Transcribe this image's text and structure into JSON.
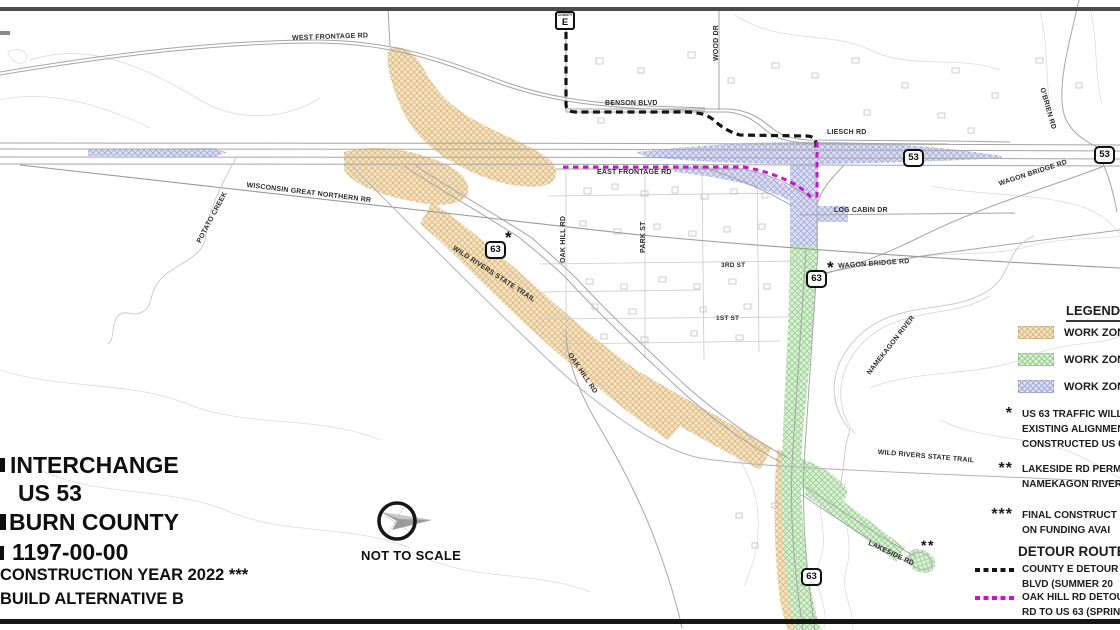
{
  "colors": {
    "orange_fill": "#f4e4c4",
    "orange_hatch": "#ddb97f",
    "green_fill": "#ddf1d7",
    "green_hatch": "#96d190",
    "purple_fill": "#dde0f3",
    "purple_hatch": "#a3abdc",
    "black_detour": "#151515",
    "magenta_detour": "#cf10cf"
  },
  "title_block": {
    "lines": [
      {
        "text": "INTERCHANGE",
        "x": 10,
        "y": 454,
        "size": 23
      },
      {
        "text": "US 53",
        "x": 18,
        "y": 482,
        "size": 23
      },
      {
        "text": "BURN COUNTY",
        "x": 9,
        "y": 511,
        "size": 23
      },
      {
        "text": "1197-00-00",
        "x": 12,
        "y": 541,
        "size": 23
      },
      {
        "text": "CONSTRUCTION YEAR 2022  ***",
        "x": 0,
        "y": 567,
        "size": 16.5
      },
      {
        "text": "BUILD ALTERNATIVE B",
        "x": 0,
        "y": 591,
        "size": 16.5
      }
    ]
  },
  "compass": {
    "label": "NOT TO SCALE"
  },
  "legend": {
    "title": "LEGEND",
    "items": [
      {
        "label": "WORK ZON",
        "fill": "#f4e4c4",
        "hatch": "#ddb97f"
      },
      {
        "label": "WORK ZON",
        "fill": "#ddf1d7",
        "hatch": "#96d190"
      },
      {
        "label": "WORK ZON",
        "fill": "#dde0f3",
        "hatch": "#a3abdc"
      }
    ],
    "notes": [
      {
        "marker": "*",
        "lines": [
          "US 63 TRAFFIC WILL",
          "EXISTING ALIGNMEN",
          "CONSTRUCTED US 6"
        ]
      },
      {
        "marker": "**",
        "lines": [
          "LAKESIDE RD PERM",
          "NAMEKAGON RIVER"
        ]
      },
      {
        "marker": "***",
        "lines": [
          "FINAL CONSTRUCT",
          "ON FUNDING AVAI"
        ]
      }
    ],
    "detours": {
      "title": "DETOUR ROUTES",
      "items": [
        {
          "color": "#151515",
          "lines": [
            "COUNTY E DETOUR",
            "BLVD (SUMMER 20"
          ]
        },
        {
          "color": "#cf10cf",
          "lines": [
            "OAK HILL RD DETOU",
            "RD TO US 63 (SPRIN"
          ]
        }
      ]
    }
  },
  "map": {
    "labels": [
      {
        "text": "WEST FRONTAGE RD",
        "x": 292,
        "y": 35,
        "rot": -2,
        "size": 7
      },
      {
        "text": "BENSON BLVD",
        "x": 605,
        "y": 100,
        "rot": 0,
        "size": 7
      },
      {
        "text": "LIESCH RD",
        "x": 827,
        "y": 129,
        "rot": 0,
        "size": 7
      },
      {
        "text": "WOOD DR",
        "x": 713,
        "y": 61,
        "rot": -90,
        "size": 7
      },
      {
        "text": "O'BRIEN RD",
        "x": 1045,
        "y": 87,
        "rot": 74,
        "size": 7
      },
      {
        "text": "EAST FRONTAGE RD",
        "x": 597,
        "y": 169,
        "rot": 0,
        "size": 7
      },
      {
        "text": "LOG CABIN DR",
        "x": 834,
        "y": 207,
        "rot": 0,
        "size": 7
      },
      {
        "text": "WISCONSIN GREAT NORTHERN RR",
        "x": 247,
        "y": 182,
        "rot": 7,
        "size": 7
      },
      {
        "text": "POTATO CREEK",
        "x": 196,
        "y": 241,
        "rot": -62,
        "size": 7
      },
      {
        "text": "WILD RIVERS STATE TRAIL",
        "x": 455,
        "y": 245,
        "rot": 33,
        "size": 7
      },
      {
        "text": "OAK HILL RD",
        "x": 560,
        "y": 263,
        "rot": -90,
        "size": 7
      },
      {
        "text": "PARK ST",
        "x": 640,
        "y": 253,
        "rot": -90,
        "size": 7
      },
      {
        "text": "3RD ST",
        "x": 721,
        "y": 263,
        "rot": 0,
        "size": 6.5
      },
      {
        "text": "1ST ST",
        "x": 716,
        "y": 316,
        "rot": 0,
        "size": 6.5
      },
      {
        "text": "OAK HILL RD",
        "x": 572,
        "y": 352,
        "rot": 56,
        "size": 7
      },
      {
        "text": "WAGON BRIDGE RD",
        "x": 838,
        "y": 263,
        "rot": -4,
        "size": 7
      },
      {
        "text": "NAMEKAGON RIVER",
        "x": 866,
        "y": 372,
        "rot": -52,
        "size": 7
      },
      {
        "text": "WILD RIVERS STATE TRAIL",
        "x": 878,
        "y": 449,
        "rot": 5,
        "size": 7
      },
      {
        "text": "LAKESIDE RD",
        "x": 870,
        "y": 540,
        "rot": 25,
        "size": 7
      },
      {
        "text": "WAGON BRIDGE RD",
        "x": 998,
        "y": 181,
        "rot": -18,
        "size": 7
      }
    ],
    "markers": [
      {
        "text": "*",
        "x": 505,
        "y": 229,
        "size": 17
      },
      {
        "text": "*",
        "x": 827,
        "y": 259,
        "size": 17
      },
      {
        "text": "**",
        "x": 921,
        "y": 538,
        "size": 14
      }
    ],
    "shields": [
      {
        "type": "county",
        "label": "E",
        "sub": "COUNTY",
        "x": 555,
        "y": 11
      },
      {
        "type": "us",
        "label": "53",
        "x": 903,
        "y": 149
      },
      {
        "type": "us",
        "label": "53",
        "x": 1094,
        "y": 146
      },
      {
        "type": "us",
        "label": "63",
        "x": 485,
        "y": 241
      },
      {
        "type": "us",
        "label": "63",
        "x": 806,
        "y": 270
      },
      {
        "type": "us",
        "label": "63",
        "x": 801,
        "y": 568
      }
    ]
  }
}
